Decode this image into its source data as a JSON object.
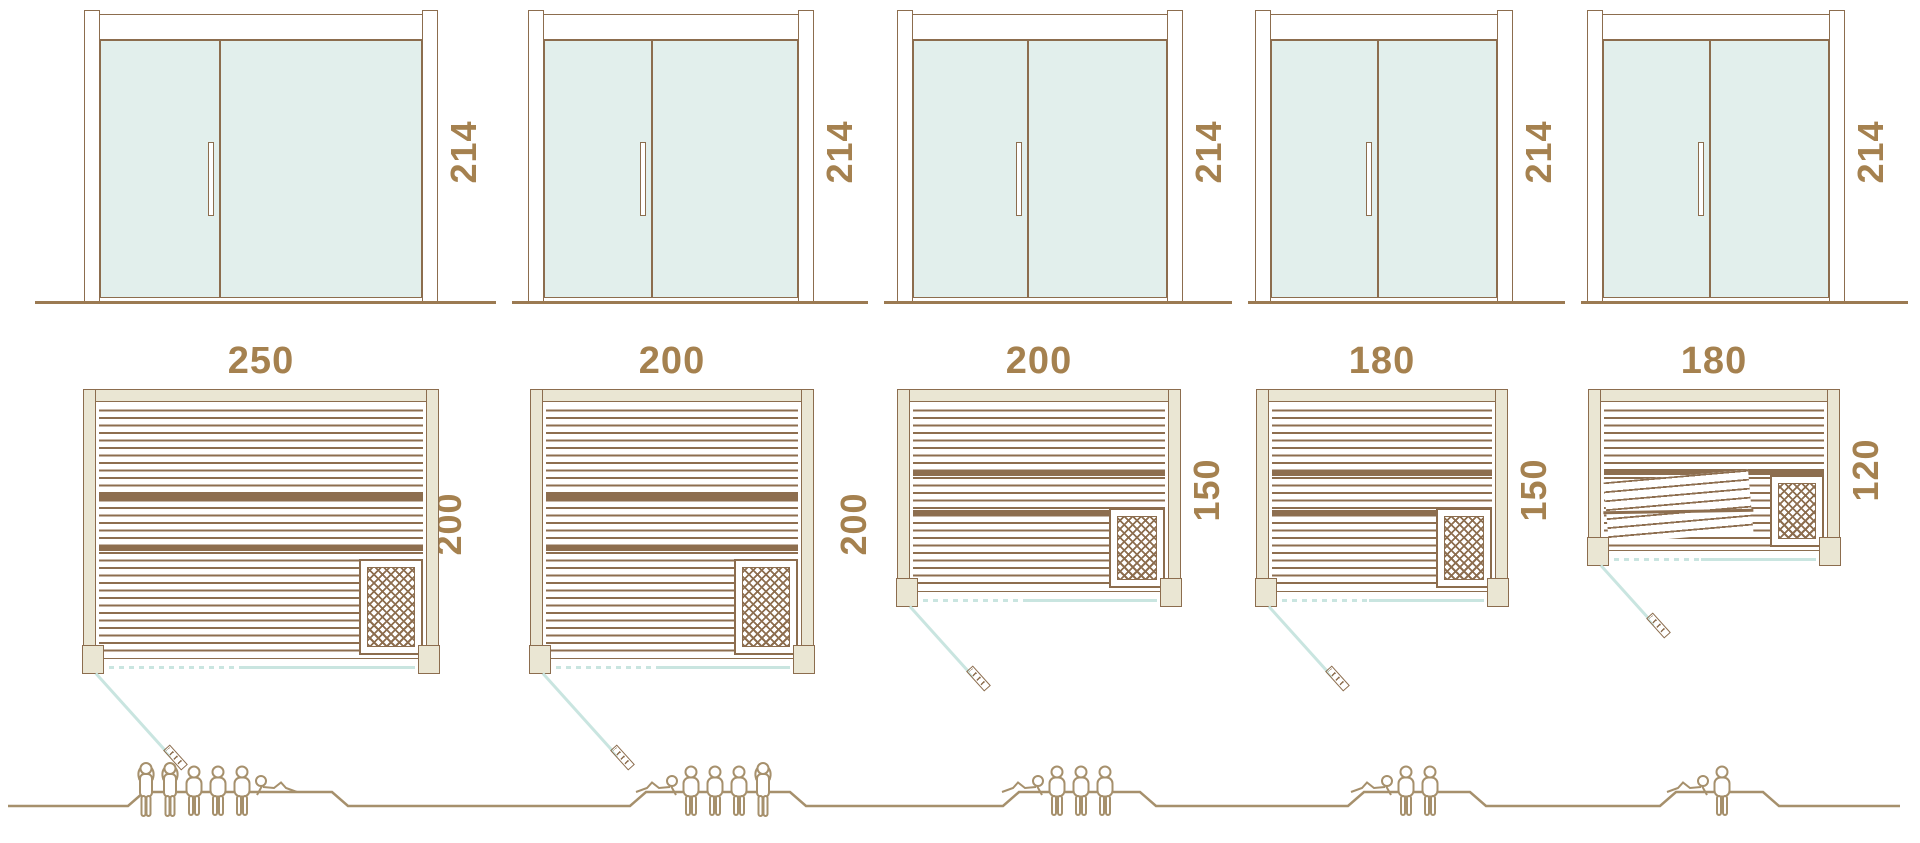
{
  "diagram_type": "sauna-size-comparison",
  "colors": {
    "outline_brown": "#8c6d4e",
    "slat_brown": "#8d6e4f",
    "label_brown": "#a5814f",
    "wall_beige": "#eae6d3",
    "glass_mint": "#e2efec",
    "door_swing_teal": "#c9e5e0",
    "figure_brown": "#a6906c",
    "ground_brown": "#9b7a52"
  },
  "modules": [
    {
      "door": {
        "height_label": "214"
      },
      "plan": {
        "width_label": "250",
        "depth_label": "200"
      },
      "occupancy": {
        "count": 6,
        "figures": [
          "standing",
          "standing",
          "seated",
          "seated",
          "seated",
          "reclining"
        ]
      }
    },
    {
      "door": {
        "height_label": "214"
      },
      "plan": {
        "width_label": "200",
        "depth_label": "200"
      },
      "occupancy": {
        "count": 5,
        "figures": [
          "reclining",
          "seated",
          "seated",
          "seated",
          "standing"
        ]
      }
    },
    {
      "door": {
        "height_label": "214"
      },
      "plan": {
        "width_label": "200",
        "depth_label": "150"
      },
      "occupancy": {
        "count": 4,
        "figures": [
          "reclining",
          "seated",
          "seated",
          "seated"
        ]
      }
    },
    {
      "door": {
        "height_label": "214"
      },
      "plan": {
        "width_label": "180",
        "depth_label": "150"
      },
      "occupancy": {
        "count": 3,
        "figures": [
          "reclining",
          "seated",
          "seated"
        ]
      }
    },
    {
      "door": {
        "height_label": "214"
      },
      "plan": {
        "width_label": "180",
        "depth_label": "120"
      },
      "occupancy": {
        "count": 2,
        "figures": [
          "reclining",
          "seated"
        ]
      }
    }
  ]
}
